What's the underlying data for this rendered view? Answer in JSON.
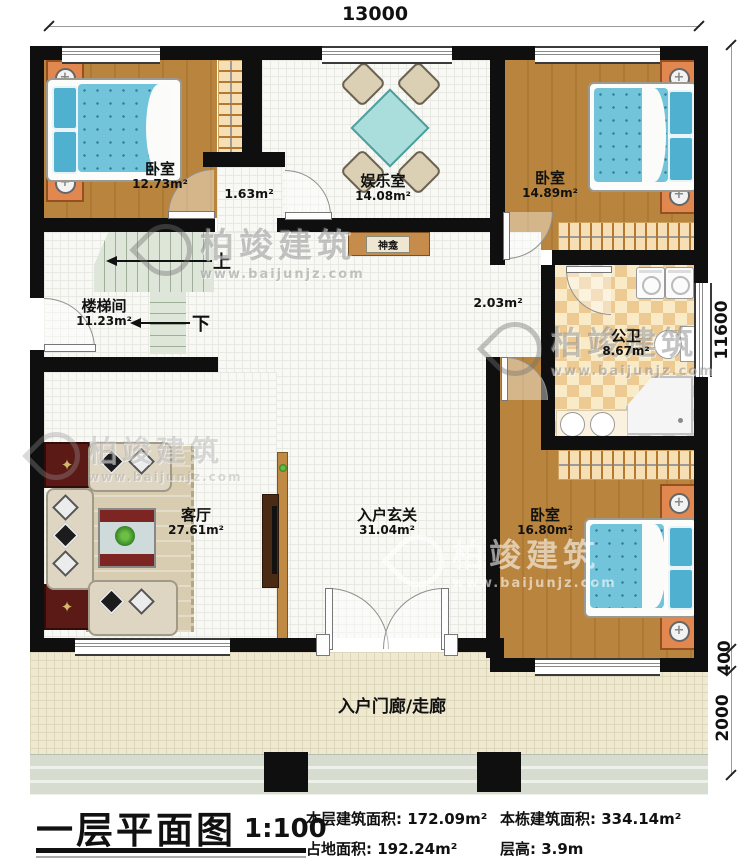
{
  "title_block": {
    "plan_title": "一层平面图",
    "scale": "1:100",
    "stats": [
      {
        "label": "本层建筑面积:",
        "value": "172.09m²"
      },
      {
        "label": "本栋建筑面积:",
        "value": "334.14m²"
      },
      {
        "label": "占地面积:",
        "value": "192.24m²"
      },
      {
        "label": "层高:",
        "value": "3.9m"
      }
    ]
  },
  "dimensions": {
    "overall_width": "13000",
    "overall_depth": "11600",
    "rear_offset": "400",
    "porch_depth": "2000"
  },
  "rooms": [
    {
      "name": "卧室",
      "area": "12.73m²"
    },
    {
      "name": "娱乐室",
      "area": "14.08m²"
    },
    {
      "name": "卧室",
      "area": "14.89m²"
    },
    {
      "name": "楼梯间",
      "area": "11.23m²"
    },
    {
      "name": "公卫",
      "area": "8.67m²"
    },
    {
      "name": "客厅",
      "area": "27.61m²"
    },
    {
      "name": "入户玄关",
      "area": "31.04m²"
    },
    {
      "name": "卧室",
      "area": "16.80m²"
    },
    {
      "name": "入户门廊/走廊",
      "area": ""
    }
  ],
  "annotations": {
    "vestibule_area": "1.63m²",
    "passage_area": "2.03m²",
    "shrine_label": "神龛",
    "stairs_up": "上",
    "stairs_down": "下"
  },
  "watermark": {
    "brand": "柏竣建筑",
    "url": "www.baijunjz.com"
  }
}
